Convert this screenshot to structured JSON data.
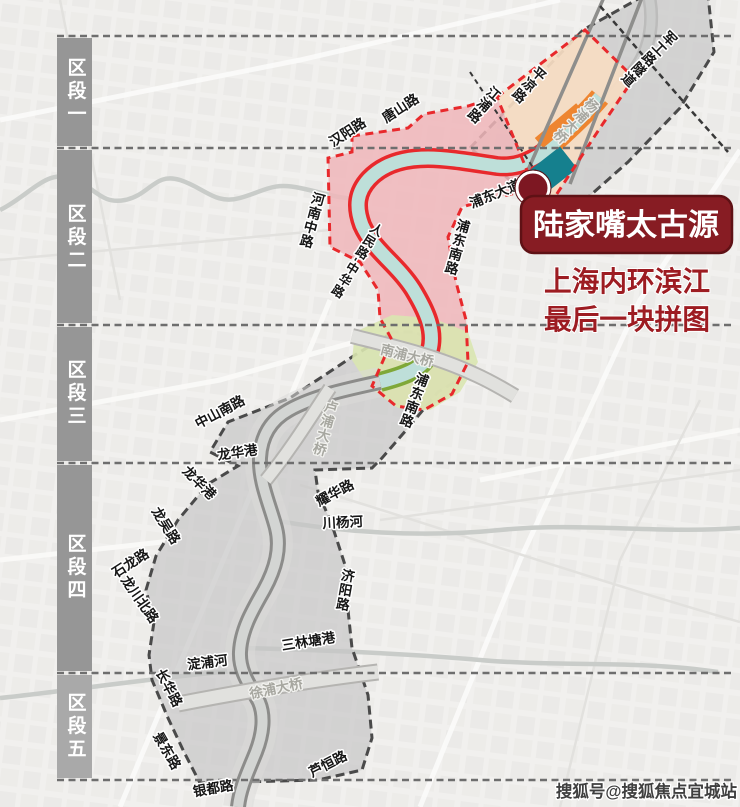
{
  "watermark": "搜狐号@搜狐焦点宜城站",
  "callout": {
    "title": "陆家嘴太古源",
    "tagline_line1": "上海内环滨江",
    "tagline_line2": "最后一块拼图"
  },
  "sections": [
    {
      "label": "区段一"
    },
    {
      "label": "区段二"
    },
    {
      "label": "区段三"
    },
    {
      "label": "区段四"
    },
    {
      "label": "区段五"
    }
  ],
  "bridges": [
    {
      "name": "杨浦大桥"
    },
    {
      "name": "南浦大桥"
    },
    {
      "name": "卢浦大桥"
    },
    {
      "name": "徐浦大桥"
    }
  ],
  "roads": [
    {
      "name": "军工路隧道"
    },
    {
      "name": "平凉路"
    },
    {
      "name": "江浦路"
    },
    {
      "name": "唐山路"
    },
    {
      "name": "汉阳路"
    },
    {
      "name": "河南中路"
    },
    {
      "name": "人民路-中华路"
    },
    {
      "name": "浦东大道"
    },
    {
      "name": "浦东南路"
    },
    {
      "name": "浦东南路"
    },
    {
      "name": "中山南路"
    },
    {
      "name": "龙华港"
    },
    {
      "name": "龙华港"
    },
    {
      "name": "龙吴路"
    },
    {
      "name": "石龙路"
    },
    {
      "name": "龙川北路"
    },
    {
      "name": "长华路"
    },
    {
      "name": "景东路"
    },
    {
      "name": "银都路"
    },
    {
      "name": "芦恒路"
    },
    {
      "name": "济阳路"
    },
    {
      "name": "耀华路"
    },
    {
      "name": "淀浦河"
    },
    {
      "name": "川杨河"
    },
    {
      "name": "三林塘港"
    }
  ],
  "colors": {
    "accent_maroon": "#871c23",
    "tagline_red": "#9d1c22",
    "zone_pink": "#f0b6ba",
    "border_red": "#e8292c",
    "river_teal": "#bedfd9",
    "plot_teal": "#15808e",
    "plot_orange": "#ee8530",
    "zone_green": "#d9e6b0",
    "zone_peach": "#f6dcc2",
    "zone_gray": "#c7c7c7",
    "section_bar_gray": "#969696"
  }
}
